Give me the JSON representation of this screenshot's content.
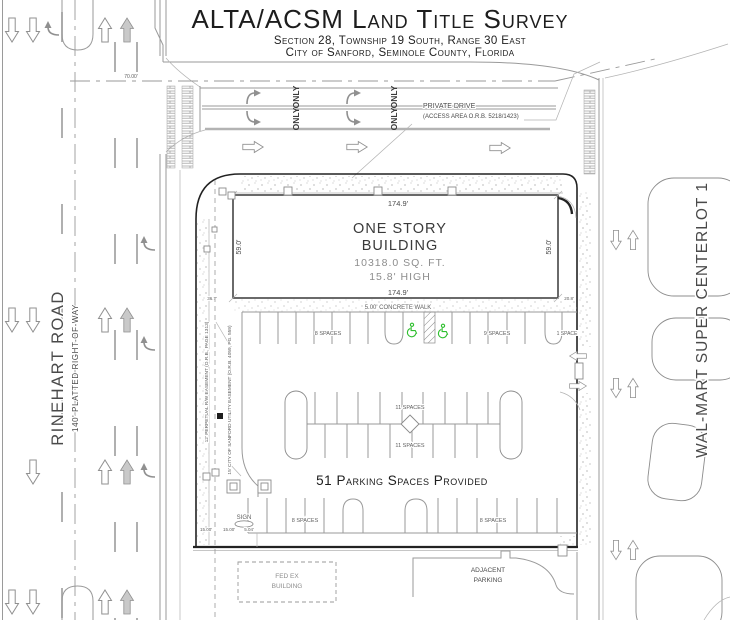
{
  "title": {
    "main": "ALTA/ACSM Land Title Survey",
    "sub1": "Section 28, Township 19 South, Range 30 East",
    "sub2": "City of Sanford, Seminole County, Florida"
  },
  "west_road": {
    "name": "RINEHART ROAD",
    "row": "140' PLATTED RIGHT-OF-WAY"
  },
  "east_side": {
    "name": "WAL-MART SUPER CENTERLOT 1"
  },
  "private_drive": {
    "label_line1": "PRIVATE DRIVE",
    "label_line2": "(ACCESS AREA O.R.B. 5218/1423)",
    "pavement_marking": "ONLY",
    "offset_dim": "70.00'"
  },
  "building": {
    "line1": "ONE STORY",
    "line2": "BUILDING",
    "area": "10318.0 SQ. FT.",
    "height": "15.8' HIGH",
    "dim_top": "174.9'",
    "dim_bottom": "174.9'",
    "dim_left": "59.0'",
    "dim_right": "59.0'"
  },
  "site": {
    "walk_label": "5.00' CONCRETE WALK",
    "corner_dim_left": "36.7'",
    "corner_dim_right": "20.8'",
    "easement_rw": "12' PERPETUAL R/W EASEMENT (O.R.B., PAGE 1313)",
    "easement_utility": "15' CITY OF SANFORD UTILITY EASEMENT (O.R.B. 4059, PG. 559)",
    "sign_label": "SIGN",
    "dim_15a": "15.00'",
    "dim_15b": "15.00'",
    "dim_5": "5.04'"
  },
  "parking": {
    "summary": "51 Parking Spaces Provided",
    "top_left": "8 SPACES",
    "top_right": "9 SPACES",
    "top_single": "1 SPACE",
    "mid_upper": "11 SPACES",
    "mid_lower": "11 SPACES",
    "bottom_left": "8 SPACES",
    "bottom_right": "8 SPACES"
  },
  "south": {
    "fedex_line1": "FED EX",
    "fedex_line2": "BUILDING",
    "adjacent_line1": "ADJACENT",
    "adjacent_line2": "PARKING"
  },
  "colors": {
    "ink": "#1d1d1d",
    "linework": "#9a9a9a",
    "handicap_green": "#2fbf2f",
    "background": "#ffffff"
  }
}
